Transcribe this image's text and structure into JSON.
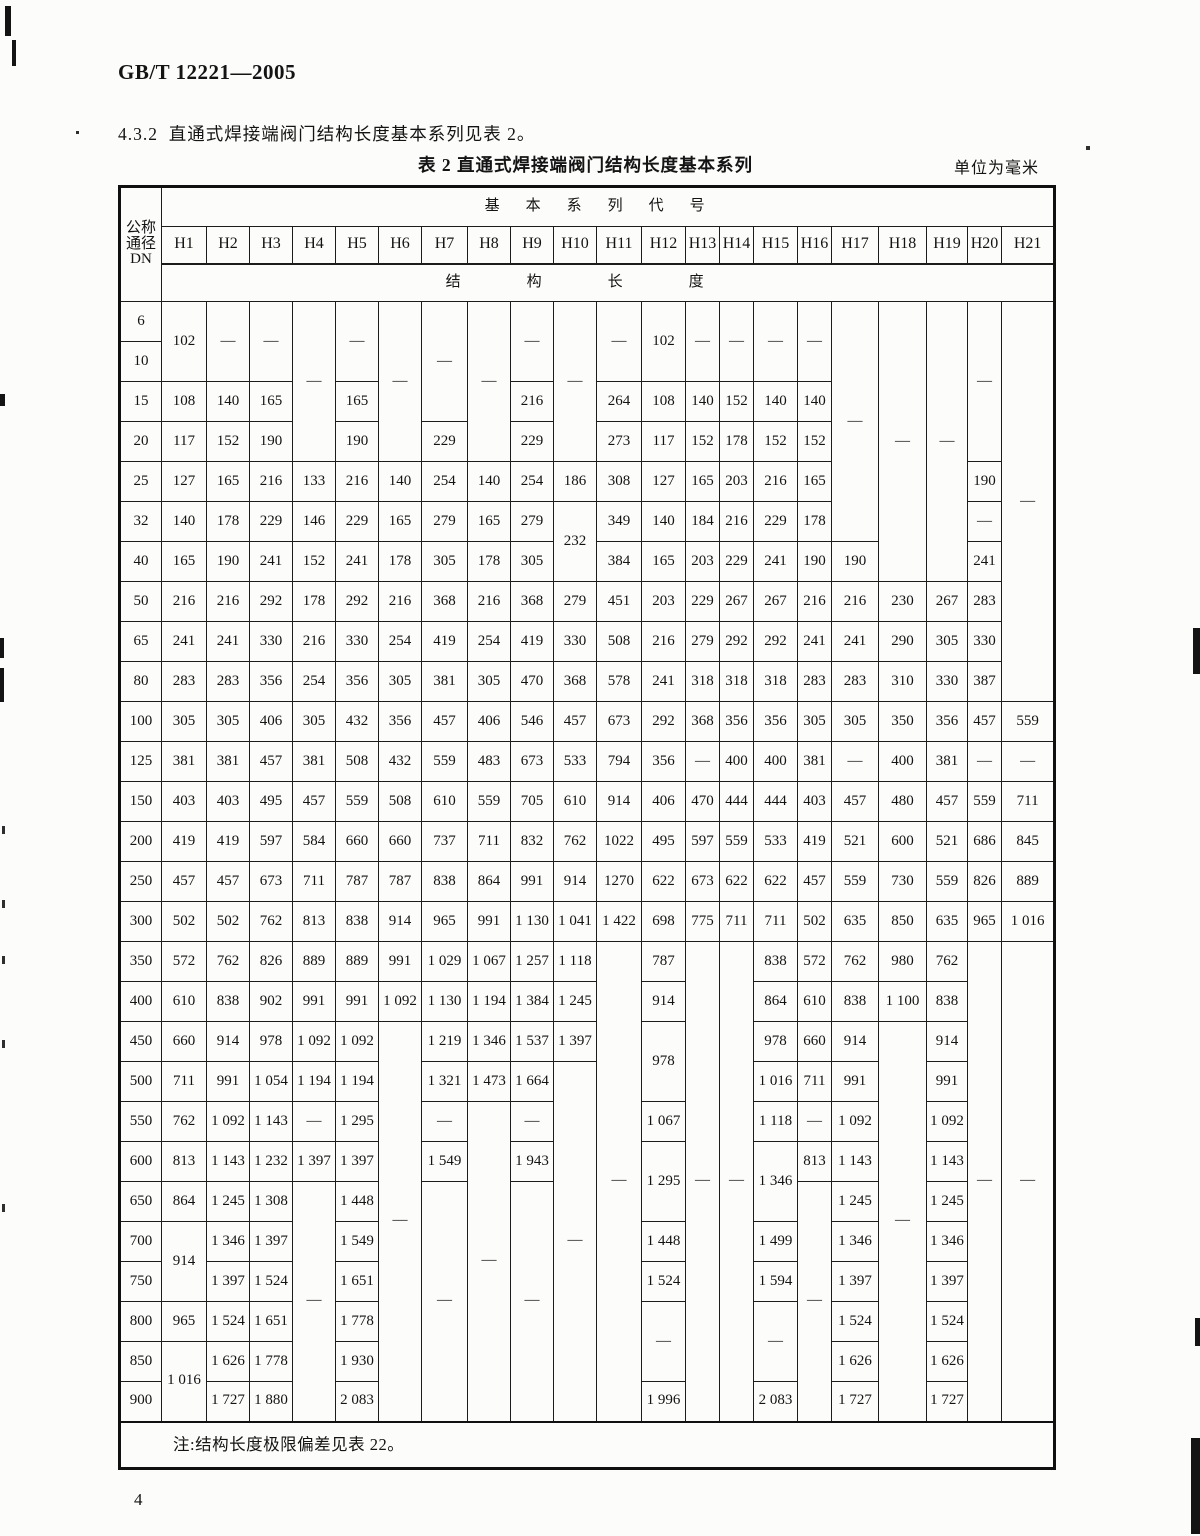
{
  "page": {
    "doc_code": "GB/T 12221—2005",
    "section_text": "4.3.2  直通式焊接端阀门结构长度基本系列见表 2。",
    "table_title": "表 2  直通式焊接端阀门结构长度基本系列",
    "unit_label": "单位为毫米",
    "page_number": "4"
  },
  "table": {
    "corner_lines": [
      "公称",
      "通径",
      "DN"
    ],
    "group_header": "基本系列代号",
    "series_labels": [
      "H1",
      "H2",
      "H3",
      "H4",
      "H5",
      "H6",
      "H7",
      "H8",
      "H9",
      "H10",
      "H11",
      "H12",
      "H13",
      "H14",
      "H15",
      "H16",
      "H17",
      "H18",
      "H19",
      "H20",
      "H21"
    ],
    "length_header": "结构长度",
    "note": "注:结构长度极限偏差见表 22。",
    "rows": [
      {
        "dn": "6",
        "cells": [
          {
            "v": "102",
            "rs": 2
          },
          {
            "v": "—",
            "rs": 2
          },
          {
            "v": "—",
            "rs": 2
          },
          {
            "v": "—",
            "rs": 4
          },
          {
            "v": "—",
            "rs": 2
          },
          {
            "v": "—",
            "rs": 4
          },
          {
            "v": "—",
            "rs": 3
          },
          {
            "v": "—",
            "rs": 4
          },
          {
            "v": "—",
            "rs": 2
          },
          {
            "v": "—",
            "rs": 4
          },
          {
            "v": "—",
            "rs": 2
          },
          {
            "v": "102",
            "rs": 2
          },
          {
            "v": "—",
            "rs": 2
          },
          {
            "v": "—",
            "rs": 2
          },
          {
            "v": "—",
            "rs": 2
          },
          {
            "v": "—",
            "rs": 2
          },
          {
            "v": "—",
            "rs": 6
          },
          {
            "v": "—",
            "rs": 7
          },
          {
            "v": "—",
            "rs": 7
          },
          {
            "v": "—",
            "rs": 4
          },
          {
            "v": "—",
            "rs": 10
          }
        ]
      },
      {
        "dn": "10",
        "cells": []
      },
      {
        "dn": "15",
        "cells": [
          "108",
          "140",
          "165",
          "165",
          "216",
          "264",
          "108",
          "140",
          "152",
          "140",
          "140"
        ]
      },
      {
        "dn": "20",
        "cells": [
          "117",
          "152",
          "190",
          "190",
          "229",
          "229",
          "273",
          "117",
          "152",
          "178",
          "152",
          "152"
        ]
      },
      {
        "dn": "25",
        "cells": [
          "127",
          "165",
          "216",
          "133",
          "216",
          "140",
          "254",
          "140",
          "254",
          "186",
          "308",
          "127",
          "165",
          "203",
          "216",
          "165",
          "190"
        ]
      },
      {
        "dn": "32",
        "cells": [
          "140",
          "178",
          "229",
          "146",
          "229",
          "165",
          "279",
          "165",
          "279",
          {
            "v": "232",
            "rs": 2
          },
          "349",
          "140",
          "184",
          "216",
          "229",
          "178",
          "—"
        ]
      },
      {
        "dn": "40",
        "cells": [
          "165",
          "190",
          "241",
          "152",
          "241",
          "178",
          "305",
          "178",
          "305",
          "384",
          "165",
          "203",
          "229",
          "241",
          "190",
          "190",
          "241"
        ]
      },
      {
        "dn": "50",
        "cells": [
          "216",
          "216",
          "292",
          "178",
          "292",
          "216",
          "368",
          "216",
          "368",
          "279",
          "451",
          "203",
          "229",
          "267",
          "267",
          "216",
          "216",
          "230",
          "267",
          "283"
        ]
      },
      {
        "dn": "65",
        "cells": [
          "241",
          "241",
          "330",
          "216",
          "330",
          "254",
          "419",
          "254",
          "419",
          "330",
          "508",
          "216",
          "279",
          "292",
          "292",
          "241",
          "241",
          "290",
          "305",
          "330"
        ]
      },
      {
        "dn": "80",
        "cells": [
          "283",
          "283",
          "356",
          "254",
          "356",
          "305",
          "381",
          "305",
          "470",
          "368",
          "578",
          "241",
          "318",
          "318",
          "318",
          "283",
          "283",
          "310",
          "330",
          "387"
        ]
      },
      {
        "dn": "100",
        "cells": [
          "305",
          "305",
          "406",
          "305",
          "432",
          "356",
          "457",
          "406",
          "546",
          "457",
          "673",
          "292",
          "368",
          "356",
          "356",
          "305",
          "305",
          "350",
          "356",
          "457",
          "559"
        ]
      },
      {
        "dn": "125",
        "cells": [
          "381",
          "381",
          "457",
          "381",
          "508",
          "432",
          "559",
          "483",
          "673",
          "533",
          "794",
          "356",
          "—",
          "400",
          "400",
          "381",
          "—",
          "400",
          "381",
          "—",
          "—"
        ]
      },
      {
        "dn": "150",
        "cells": [
          "403",
          "403",
          "495",
          "457",
          "559",
          "508",
          "610",
          "559",
          "705",
          "610",
          "914",
          "406",
          "470",
          "444",
          "444",
          "403",
          "457",
          "480",
          "457",
          "559",
          "711"
        ]
      },
      {
        "dn": "200",
        "cells": [
          "419",
          "419",
          "597",
          "584",
          "660",
          "660",
          "737",
          "711",
          "832",
          "762",
          "1022",
          "495",
          "597",
          "559",
          "533",
          "419",
          "521",
          "600",
          "521",
          "686",
          "845"
        ]
      },
      {
        "dn": "250",
        "cells": [
          "457",
          "457",
          "673",
          "711",
          "787",
          "787",
          "838",
          "864",
          "991",
          "914",
          "1270",
          "622",
          "673",
          "622",
          "622",
          "457",
          "559",
          "730",
          "559",
          "826",
          "889"
        ]
      },
      {
        "dn": "300",
        "cells": [
          "502",
          "502",
          "762",
          "813",
          "838",
          "914",
          "965",
          "991",
          "1 130",
          "1 041",
          "1 422",
          "698",
          "775",
          "711",
          "711",
          "502",
          "635",
          "850",
          "635",
          "965",
          "1 016"
        ]
      },
      {
        "dn": "350",
        "cells": [
          "572",
          "762",
          "826",
          "889",
          "889",
          "991",
          "1 029",
          "1 067",
          "1 257",
          "1 118",
          {
            "v": "—",
            "rs": 12
          },
          "787",
          {
            "v": "—",
            "rs": 12
          },
          {
            "v": "—",
            "rs": 12
          },
          "838",
          "572",
          "762",
          "980",
          "762",
          {
            "v": "—",
            "rs": 12
          },
          {
            "v": "—",
            "rs": 12
          }
        ]
      },
      {
        "dn": "400",
        "cells": [
          "610",
          "838",
          "902",
          "991",
          "991",
          "1 092",
          "1 130",
          "1 194",
          "1 384",
          "1 245",
          "914",
          "864",
          "610",
          "838",
          "1 100",
          "838"
        ]
      },
      {
        "dn": "450",
        "cells": [
          "660",
          "914",
          "978",
          "1 092",
          "1 092",
          {
            "v": "—",
            "rs": 10
          },
          "1 219",
          "1 346",
          "1 537",
          "1 397",
          {
            "v": "978",
            "rs": 2
          },
          "978",
          "660",
          "914",
          {
            "v": "—",
            "rs": 10
          },
          "914"
        ]
      },
      {
        "dn": "500",
        "cells": [
          "711",
          "991",
          "1 054",
          "1 194",
          "1 194",
          "1 321",
          "1 473",
          "1 664",
          {
            "v": "—",
            "rs": 9
          },
          "1 016",
          "711",
          "991",
          "991"
        ]
      },
      {
        "dn": "550",
        "cells": [
          "762",
          "1 092",
          "1 143",
          "—",
          "1 295",
          "—",
          {
            "v": "—",
            "rs": 8
          },
          "—",
          "1 067",
          "1 118",
          "—",
          "1 092",
          "1 092"
        ]
      },
      {
        "dn": "600",
        "cells": [
          "813",
          "1 143",
          "1 232",
          "1 397",
          "1 397",
          "1 549",
          "1 943",
          {
            "v": "1 295",
            "rs": 2
          },
          {
            "v": "1 346",
            "rs": 2
          },
          "813",
          "1 143",
          "1 143"
        ]
      },
      {
        "dn": "650",
        "cells": [
          "864",
          "1 245",
          "1 308",
          {
            "v": "—",
            "rs": 6
          },
          "1 448",
          {
            "v": "—",
            "rs": 6
          },
          {
            "v": "—",
            "rs": 6
          },
          {
            "v": "—",
            "rs": 6
          },
          "1 245",
          "1 245"
        ]
      },
      {
        "dn": "700",
        "cells": [
          {
            "v": "914",
            "rs": 2
          },
          "1 346",
          "1 397",
          "1 549",
          "1 448",
          "1 499",
          "1 346",
          "1 346"
        ]
      },
      {
        "dn": "750",
        "cells": [
          "1 397",
          "1 524",
          "1 651",
          "1 524",
          "1 594",
          "1 397",
          "1 397"
        ]
      },
      {
        "dn": "800",
        "cells": [
          "965",
          "1 524",
          "1 651",
          "1 778",
          {
            "v": "—",
            "rs": 2
          },
          {
            "v": "—",
            "rs": 2
          },
          "1 524",
          "1 524"
        ]
      },
      {
        "dn": "850",
        "cells": [
          {
            "v": "1 016",
            "rs": 2
          },
          "1 626",
          "1 778",
          "1 930",
          "1 626",
          "1 626"
        ]
      },
      {
        "dn": "900",
        "cells": [
          "1 727",
          "1 880",
          "2 083",
          "1 996",
          "2 083",
          "1 727",
          "1 727"
        ]
      }
    ]
  }
}
